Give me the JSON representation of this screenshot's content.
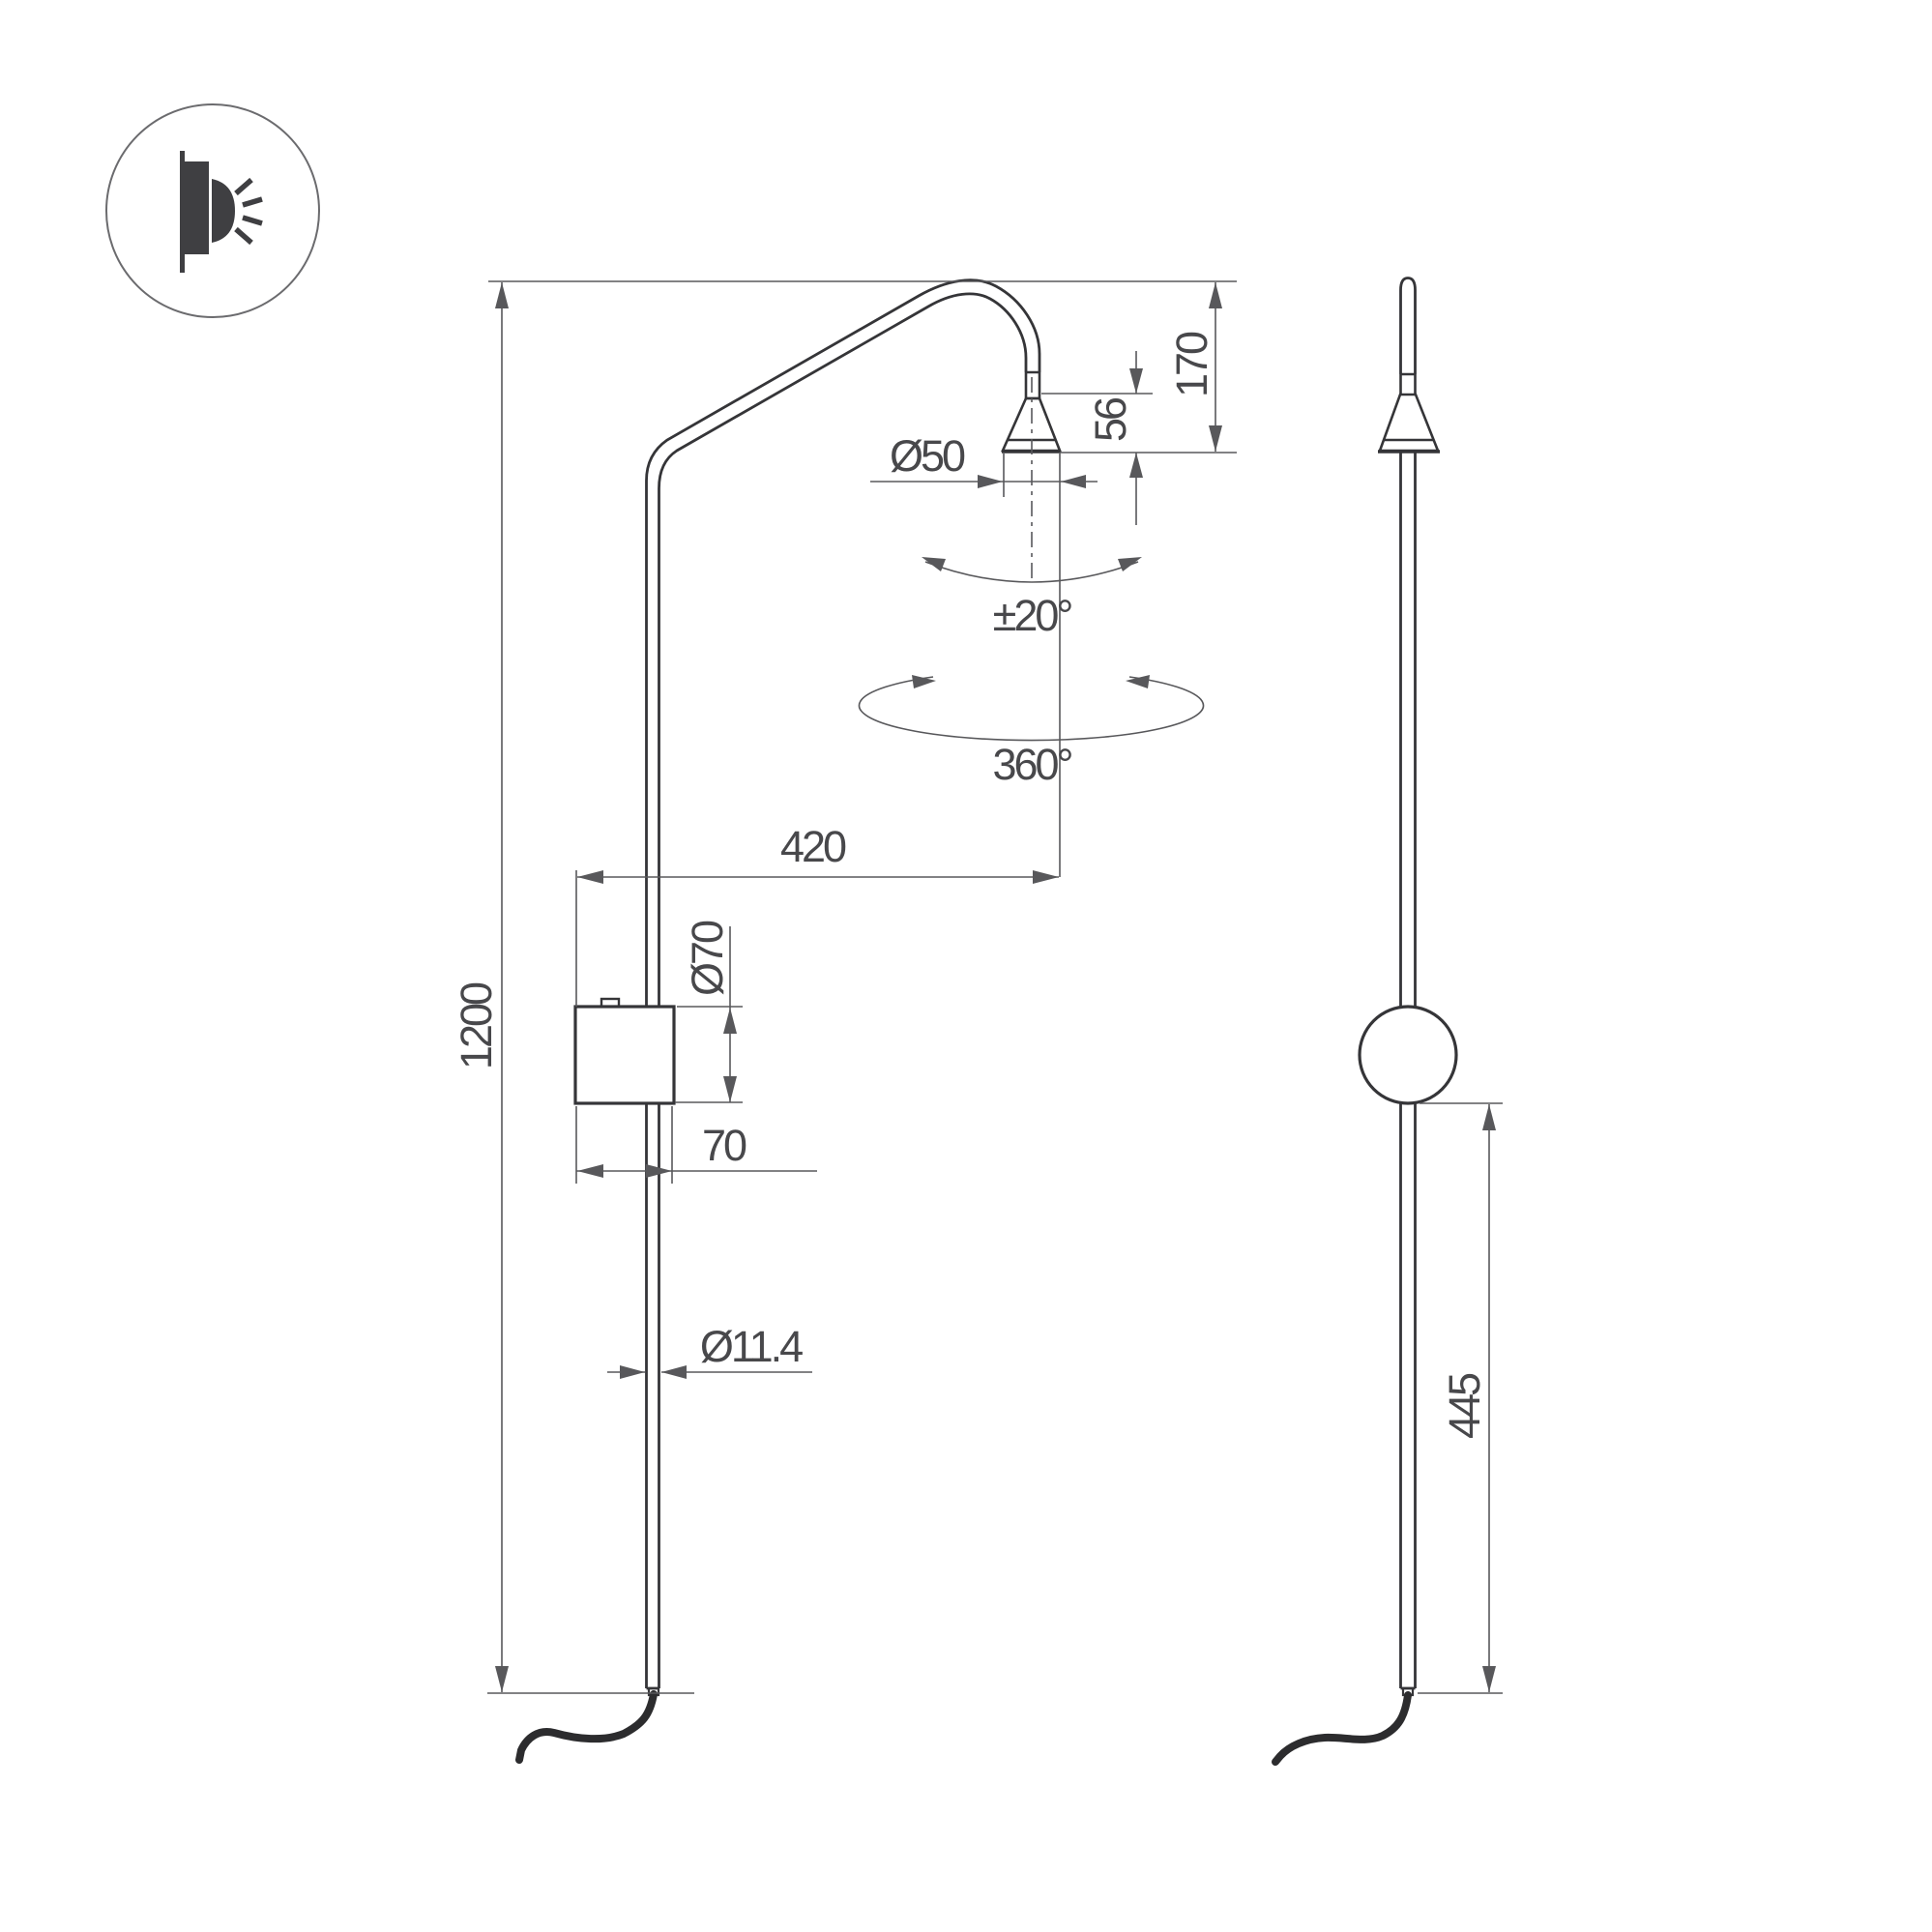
{
  "background": "#ffffff",
  "palette": {
    "product_outline": "#353538",
    "dimension_lines": "#58585b",
    "label_text": "#48484b",
    "icon_fill": "#3f3f42"
  },
  "icon": {
    "name": "wall-light-icon",
    "description": "wall-mounted light emitting rays, inside circle badge"
  },
  "views": {
    "left": "front elevation of wall lamp",
    "right": "side elevation of wall lamp"
  },
  "labels": {
    "total_height": "1200",
    "arm_projection": "420",
    "head_offset": "170",
    "head_cone_height": "56",
    "head_diameter": "Ø50",
    "canopy_diameter": "Ø70",
    "canopy_width": "70",
    "pole_diameter": "Ø11.4",
    "tilt_range": "±20°",
    "swivel_range": "360°",
    "lower_section_length": "445"
  }
}
